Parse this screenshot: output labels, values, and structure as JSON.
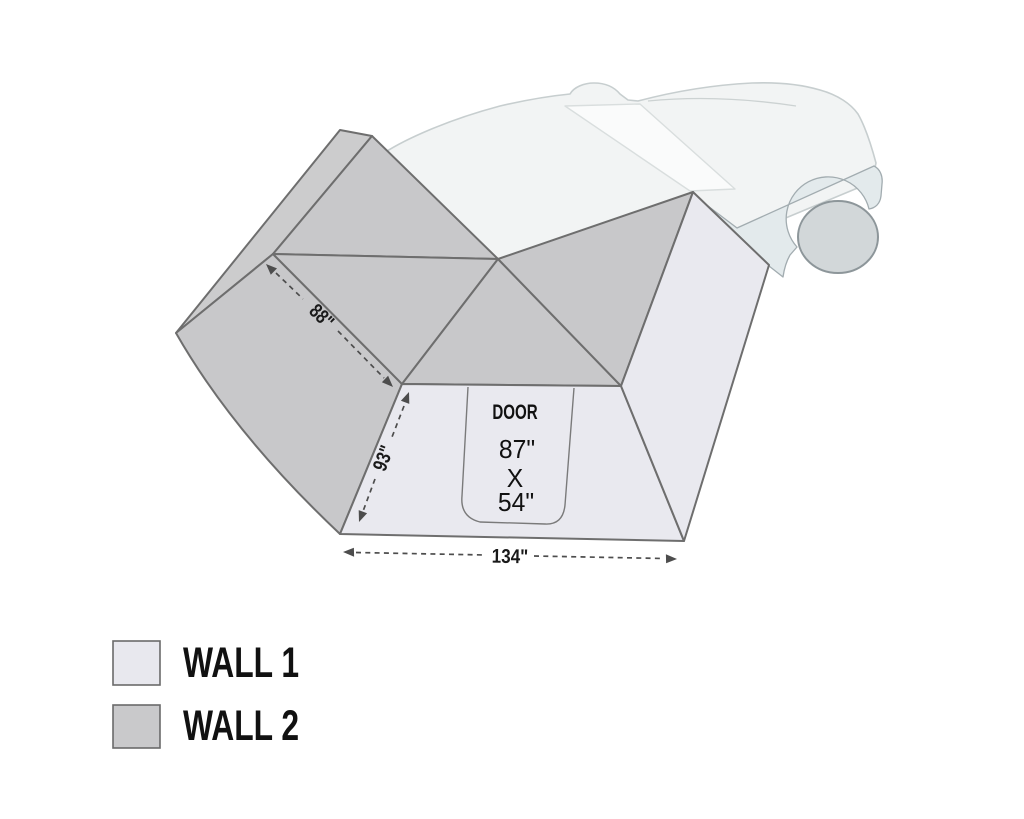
{
  "awning": {
    "door": {
      "label": "DOOR",
      "width": "87\"",
      "by": "X",
      "height": "54\""
    },
    "dims": {
      "roof_edge": "88\"",
      "side_edge": "93\"",
      "bottom_edge": "134\""
    }
  },
  "legend": {
    "items": [
      {
        "label": "WALL 1",
        "color": "#e8e8ee"
      },
      {
        "label": "WALL 2",
        "color": "#c9c9cb"
      }
    ]
  },
  "colors": {
    "wall1": "#e9e9ef",
    "wall2": "#c8c8ca",
    "wall2_light": "#cccccd",
    "outline": "#6e6e6e",
    "dimension": "#4d4d4d",
    "car_body": "#f2f4f4",
    "car_window": "#fafbfb",
    "car_lower": "#e3eaec",
    "car_wheel": "#d2d7d9"
  }
}
